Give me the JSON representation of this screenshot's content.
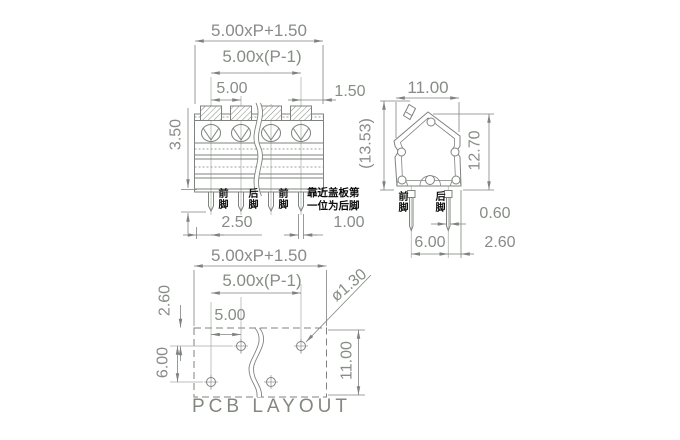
{
  "colors": {
    "line": "#7f837f",
    "centerline": "#a5aca4",
    "dim_text": "#878c86",
    "cjk_text": "#0d0d0d",
    "background": "#ffffff"
  },
  "views": {
    "front": {
      "dims": {
        "overall": "5.00xP+1.50",
        "span": "5.00x(P-1)",
        "pitch": "5.00",
        "edge": "1.50",
        "pin_length": "3.50",
        "offset": "2.50",
        "pin_width": "1.00"
      },
      "labels": {
        "front_foot": "前脚",
        "rear_foot": "后脚",
        "front_foot2": "前脚",
        "note": "靠近盖板第\n一位为后脚"
      }
    },
    "side": {
      "dims": {
        "width": "11.00",
        "total_height": "(13.53)",
        "height": "12.70",
        "pin_thickness": "0.60",
        "pin_spacing": "6.00",
        "edge": "2.60"
      },
      "labels": {
        "front_foot": "前脚",
        "rear_foot": "后脚"
      }
    },
    "pcb": {
      "dims": {
        "overall": "5.00xP+1.50",
        "span": "5.00x(P-1)",
        "pitch": "5.00",
        "hole_diameter": "ø1.30",
        "top_offset": "2.60",
        "row_spacing": "6.00",
        "height": "11.00"
      },
      "caption": "PCB LAYOUT"
    }
  }
}
